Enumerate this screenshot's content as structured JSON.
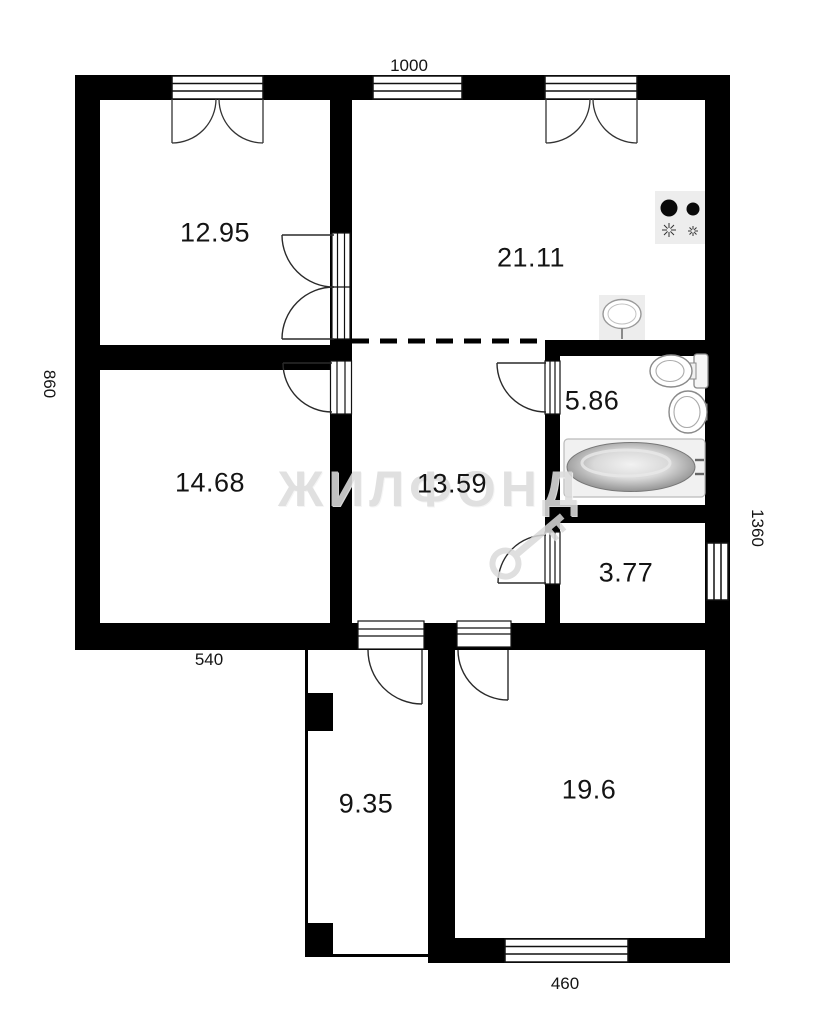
{
  "watermark": {
    "brand": "ЖИЛФОНД"
  },
  "rooms": [
    {
      "id": "room-top-left",
      "area": "12.95"
    },
    {
      "id": "kitchen",
      "area": "21.11"
    },
    {
      "id": "room-mid-left",
      "area": "14.68"
    },
    {
      "id": "hallway",
      "area": "13.59"
    },
    {
      "id": "bathroom",
      "area": "5.86"
    },
    {
      "id": "storage",
      "area": "3.77"
    },
    {
      "id": "veranda",
      "area": "9.35"
    },
    {
      "id": "room-bottom",
      "area": "19.6"
    }
  ],
  "dimensions": {
    "top": "1000",
    "left": "860",
    "bottom_left": "540",
    "right": "1360",
    "bottom": "460"
  },
  "colors": {
    "wall": "#000000",
    "watermark": "#dcdcdc",
    "fixture_stroke": "#8a8a8a"
  },
  "icons": [
    "stove-icon",
    "kitchen-sink-icon",
    "toilet-icon",
    "washbasin-icon",
    "bathtub-icon",
    "key-logo",
    "window-symbol",
    "door-swing"
  ]
}
